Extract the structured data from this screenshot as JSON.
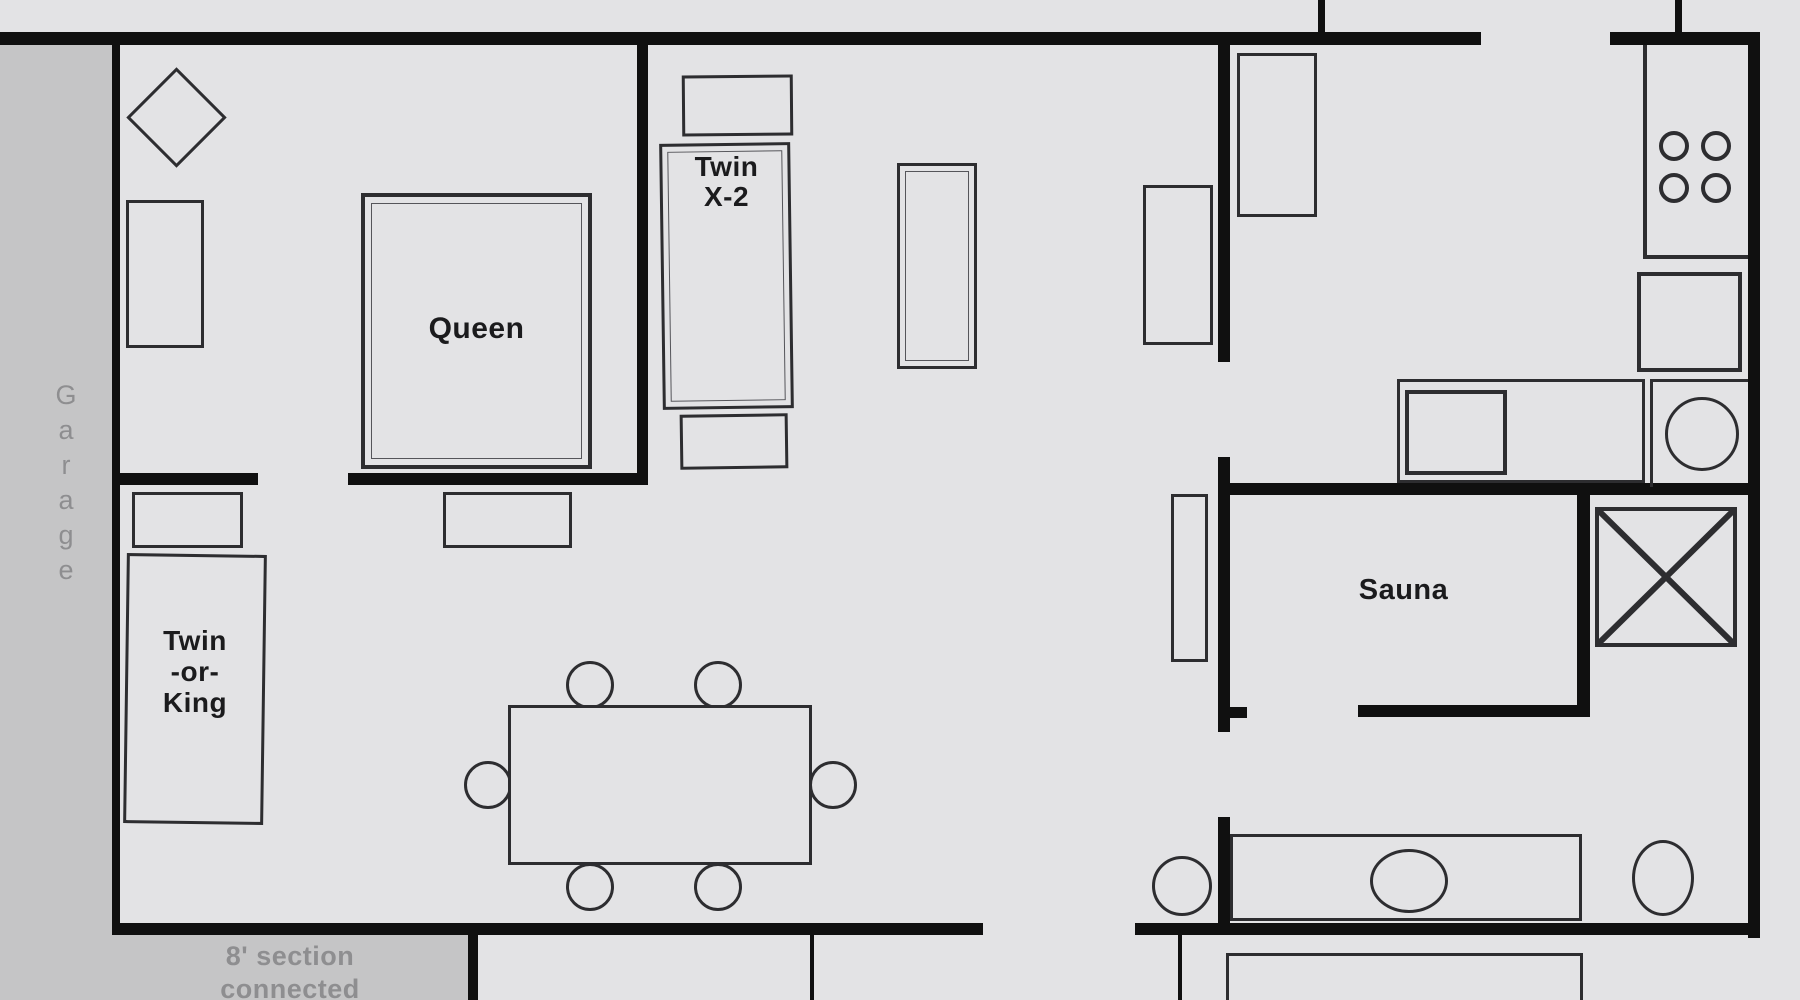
{
  "plan": {
    "labels": {
      "garage": "Garage",
      "queen": "Queen",
      "twin_x2": [
        "Twin",
        "X-2"
      ],
      "twin_or_king": [
        "Twin",
        "-or-",
        "King"
      ],
      "sauna": "Sauna",
      "section": [
        "8' section",
        "connected"
      ]
    },
    "colors": {
      "floor": "#e3e3e5",
      "strip": "#c5c5c6",
      "wall": "#101010",
      "furn": "#2d2d30",
      "label": "#1b1b1d",
      "muted": "#8e8e90"
    }
  }
}
